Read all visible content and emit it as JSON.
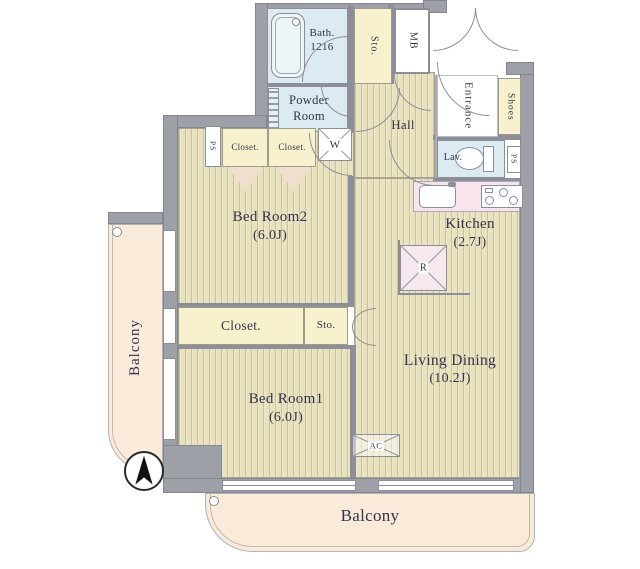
{
  "plan": {
    "rooms": {
      "bath": {
        "name": "Bath.",
        "size": "1216"
      },
      "powder_room": {
        "line1": "Powder",
        "line2": "Room"
      },
      "sto_top": "Sto.",
      "mb": "MB",
      "entrance": "Entrance",
      "shoes": "Shoes",
      "hall": "Hall",
      "lav": "Lav.",
      "ps_upper_left": "PS",
      "ps_lavatory": "PS",
      "closet_a": "Closet.",
      "closet_b": "Closet.",
      "washer": "W",
      "bedroom2": {
        "name": "Bed Room2",
        "size": "(6.0J)"
      },
      "kitchen": {
        "name": "Kitchen",
        "size": "(2.7J)"
      },
      "refrigerator": "R",
      "closet_mid": "Closet.",
      "sto_mid": "Sto.",
      "living_dining": {
        "name": "Living Dining",
        "size": "(10.2J)"
      },
      "bedroom1": {
        "name": "Bed Room1",
        "size": "(6.0J)"
      },
      "balcony_left": "Balcony",
      "balcony_bottom": "Balcony",
      "ac": "AC"
    },
    "colors": {
      "wall": "#9ea0a8",
      "wood_floor": "#e8e2bf",
      "closet": "#f7f1cd",
      "wet_room": "#dcebf2",
      "kitchen_counter": "#f8e4ed",
      "balcony": "#faeada",
      "label_text": "#33334a"
    }
  }
}
